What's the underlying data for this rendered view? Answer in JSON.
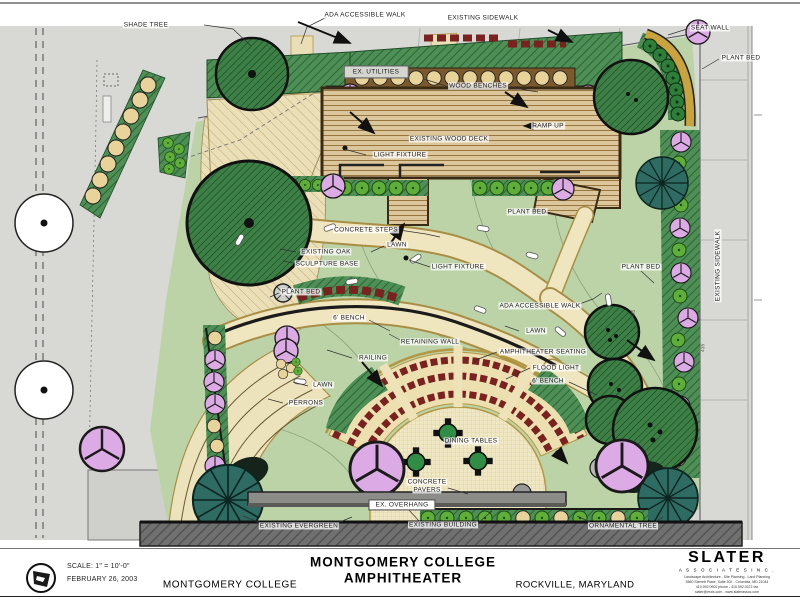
{
  "drawing": {
    "labels": [
      {
        "text": "SHADE TREE",
        "x": 146,
        "y": 25
      },
      {
        "text": "ADA ACCESSIBLE WALK",
        "x": 365,
        "y": 15
      },
      {
        "text": "EXISTING SIDEWALK",
        "x": 483,
        "y": 18
      },
      {
        "text": "SEAT WALL",
        "x": 710,
        "y": 28
      },
      {
        "text": "PLANT BED",
        "x": 741,
        "y": 58
      },
      {
        "text": "WOOD BENCHES",
        "x": 478,
        "y": 86
      },
      {
        "text": "RAMP UP",
        "x": 548,
        "y": 126
      },
      {
        "text": "EXISTING WOOD DECK",
        "x": 449,
        "y": 139
      },
      {
        "text": "LIGHT FIXTURE",
        "x": 400,
        "y": 155
      },
      {
        "text": "PLANT BED",
        "x": 527,
        "y": 212
      },
      {
        "text": "CONCRETE STEPS",
        "x": 366,
        "y": 230
      },
      {
        "text": "LAWN",
        "x": 397,
        "y": 245
      },
      {
        "text": "EXISTING OAK",
        "x": 326,
        "y": 252
      },
      {
        "text": "SCULPTURE BASE",
        "x": 327,
        "y": 264
      },
      {
        "text": "LIGHT FIXTURE",
        "x": 458,
        "y": 267
      },
      {
        "text": "PLANT BED",
        "x": 641,
        "y": 267
      },
      {
        "text": "PLANT BED",
        "x": 301,
        "y": 292
      },
      {
        "text": "ADA ACCESSIBLE WALK",
        "x": 540,
        "y": 306
      },
      {
        "text": "6' BENCH",
        "x": 349,
        "y": 318
      },
      {
        "text": "LAWN",
        "x": 536,
        "y": 331
      },
      {
        "text": "RETAINING WALL",
        "x": 430,
        "y": 342
      },
      {
        "text": "AMPHITHEATER SEATING",
        "x": 543,
        "y": 352
      },
      {
        "text": "RAILING",
        "x": 373,
        "y": 358
      },
      {
        "text": "FLOOD LIGHT",
        "x": 556,
        "y": 368
      },
      {
        "text": "6' BENCH",
        "x": 548,
        "y": 381
      },
      {
        "text": "LAWN",
        "x": 323,
        "y": 385
      },
      {
        "text": "PERRONS",
        "x": 306,
        "y": 403
      },
      {
        "text": "DINING TABLES",
        "x": 471,
        "y": 441
      },
      {
        "text": "CONCRETE",
        "x": 427,
        "y": 482
      },
      {
        "text": "PAVERS",
        "x": 427,
        "y": 490
      },
      {
        "text": "EXISTING BUILDING",
        "x": 443,
        "y": 525
      },
      {
        "text": "EXISTING EVERGREEN",
        "x": 299,
        "y": 526
      },
      {
        "text": "ORNAMENTAL TREE",
        "x": 623,
        "y": 526
      },
      {
        "text": "EXISTING SIDEWALK",
        "x": 718,
        "y": 266
      }
    ],
    "boxed_labels": {
      "utilities": {
        "text": "EX. UTILITIES",
        "x": 376,
        "y": 72
      },
      "overhang": {
        "text": "EX. OVERHANG",
        "x": 402,
        "y": 505
      }
    },
    "contour_labels": [
      {
        "text": "435",
        "x": 634,
        "y": 314
      },
      {
        "text": "435",
        "x": 704,
        "y": 348
      }
    ]
  },
  "title_block": {
    "scale": "SCALE: 1\" = 10'-0\"",
    "date": "FEBRUARY 26, 2003",
    "client": "MONTGOMERY COLLEGE",
    "title_line1": "MONTGOMERY COLLEGE",
    "title_line2": "AMPHITHEATER",
    "location": "ROCKVILLE, MARYLAND",
    "firm": {
      "name": "SLATER",
      "subtitle": "A S S O C I A T E S   I N C .",
      "lines": [
        "Landscape Architecture - Site Planning - Land Planning",
        "5560 Sterrett Place, Suite 302 - Columbia, MD 21044",
        "410.992.0900 phone - 410.992.0372 fax",
        "slater@erols.com - www.slaterassoc.com"
      ]
    }
  },
  "colors": {
    "lawn": "#bcd3a8",
    "plant_bed": "#4d8f55",
    "tree_canopy": "#3c8046",
    "walk": "#efe6c0",
    "pavers": "#f0e8c4",
    "deck": "#dcc69b",
    "bench_red": "#7a2220",
    "ornamental_tree": "#dcaae4",
    "evergreen": "#2e6b62",
    "building": "#707070",
    "road": "#d8d8d4",
    "curb_gold": "#b49743"
  }
}
